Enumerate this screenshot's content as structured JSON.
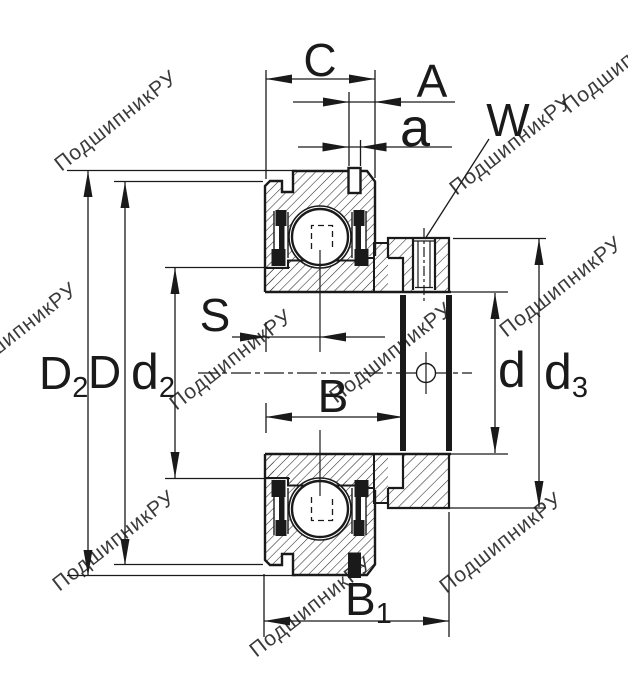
{
  "drawing": {
    "kind": "bearing cross-section technical drawing",
    "dims": {
      "C": {
        "text": "C"
      },
      "A": {
        "text": "A"
      },
      "a": {
        "text": "a"
      },
      "W": {
        "text": "W"
      },
      "S": {
        "text": "S"
      },
      "B": {
        "text": "B"
      },
      "B1": {
        "text": "B",
        "sub": "1"
      },
      "D2": {
        "text": "D",
        "sub": "2"
      },
      "D": {
        "text": "D"
      },
      "d2": {
        "text": "d",
        "sub": "2"
      },
      "d": {
        "text": "d"
      },
      "d3": {
        "text": "d",
        "sub": "3"
      }
    },
    "watermark": {
      "text": "ПодшипникРУ",
      "color": "#c5c5c5"
    },
    "colors": {
      "line": "#1a1a1a",
      "background": "#ffffff"
    }
  }
}
